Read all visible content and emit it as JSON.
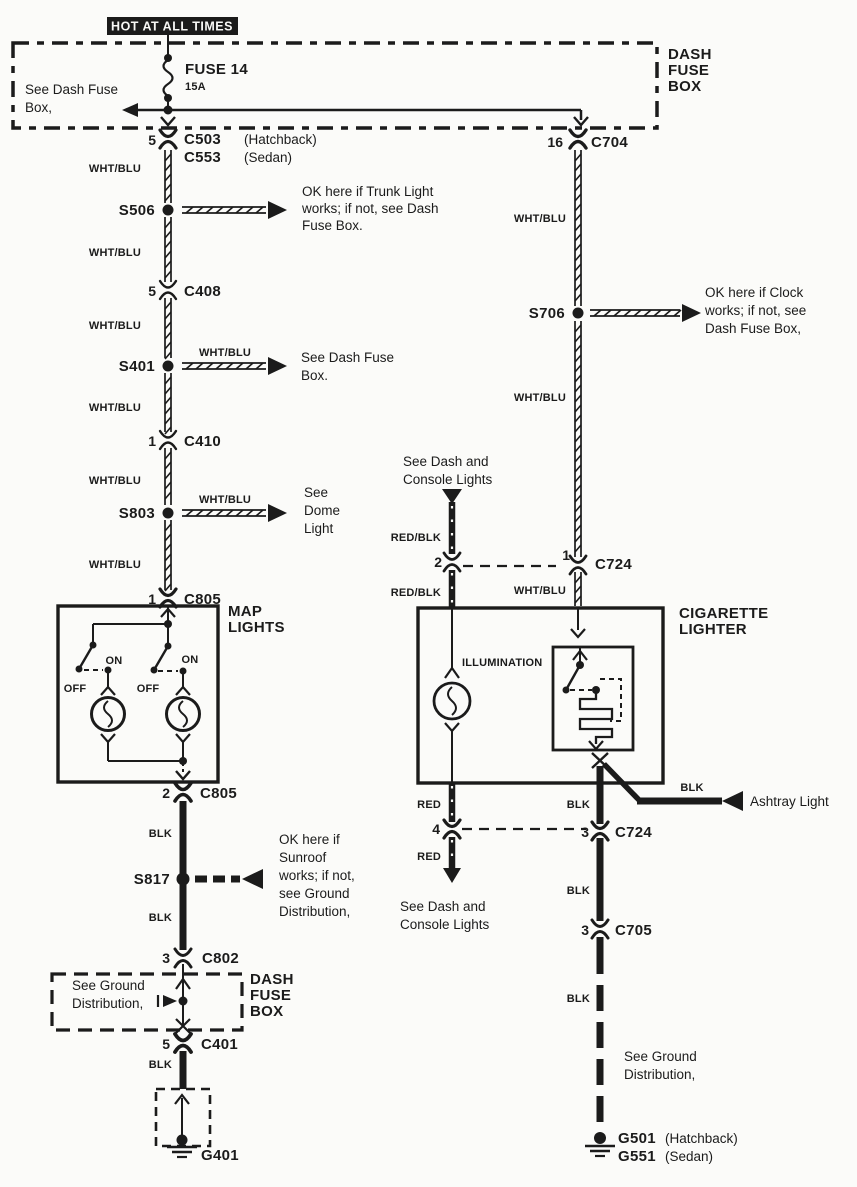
{
  "banner": {
    "text": "HOT AT ALL TIMES"
  },
  "colors": {
    "wht_blu": "WHT/BLU",
    "blk": "BLK",
    "red": "RED",
    "red_blk": "RED/BLK"
  },
  "top_fuse_box": {
    "title": [
      "DASH",
      "FUSE",
      "BOX"
    ],
    "note": [
      "See Dash Fuse",
      "Box,"
    ],
    "fuse_name": "FUSE 14",
    "fuse_rating": "15A"
  },
  "left": {
    "c503": {
      "pin": "5",
      "name": "C503",
      "variant": "(Hatchback)",
      "alt": "C553",
      "alt_variant": "(Sedan)"
    },
    "s506": {
      "id": "S506",
      "note": [
        "OK here if Trunk Light",
        "works; if not, see Dash",
        "Fuse Box."
      ]
    },
    "c408": {
      "pin": "5",
      "name": "C408"
    },
    "s401": {
      "id": "S401",
      "arrow_label": "WHT/BLU",
      "note": [
        "See Dash Fuse",
        "Box."
      ]
    },
    "c410": {
      "pin": "1",
      "name": "C410"
    },
    "s803": {
      "id": "S803",
      "arrow_label": "WHT/BLU",
      "note": [
        "See",
        "Dome",
        "Light"
      ]
    },
    "c805_top": {
      "pin": "1",
      "name": "C805"
    },
    "c805_bottom": {
      "pin": "2",
      "name": "C805"
    },
    "s817": {
      "id": "S817",
      "note": [
        "OK here if",
        "Sunroof",
        "works; if not,",
        "see Ground",
        "Distribution,"
      ]
    },
    "c802": {
      "pin": "3",
      "name": "C802"
    },
    "c401": {
      "pin": "5",
      "name": "C401"
    },
    "g401": {
      "name": "G401"
    }
  },
  "map_lights": {
    "title": [
      "MAP",
      "LIGHTS"
    ],
    "on": "ON",
    "off": "OFF"
  },
  "bottom_fuse_box": {
    "title": [
      "DASH",
      "FUSE",
      "BOX"
    ],
    "note": [
      "See Ground",
      "Distribution,"
    ]
  },
  "cigarette_lighter": {
    "title": [
      "CIGARETTE",
      "LIGHTER"
    ],
    "illumination": "ILLUMINATION"
  },
  "right": {
    "c704": {
      "pin": "16",
      "name": "C704"
    },
    "s706": {
      "id": "S706",
      "note": [
        "OK here if Clock",
        "works; if not, see",
        "Dash Fuse Box,"
      ]
    },
    "dash_console_in": [
      "See Dash and",
      "Console Lights"
    ],
    "c724_top": {
      "pin_left": "2",
      "pin_right": "1",
      "name": "C724"
    },
    "c724_bottom": {
      "pin_left": "4",
      "pin_right": "3",
      "name": "C724"
    },
    "dash_console_out": [
      "See Dash and",
      "Console Lights"
    ],
    "ashtray": "Ashtray Light",
    "c705": {
      "pin": "3",
      "name": "C705"
    },
    "ground_note": [
      "See Ground",
      "Distribution,"
    ],
    "g501": {
      "name": "G501",
      "variant": "(Hatchback)"
    },
    "g551": {
      "name": "G551",
      "variant": "(Sedan)"
    }
  }
}
